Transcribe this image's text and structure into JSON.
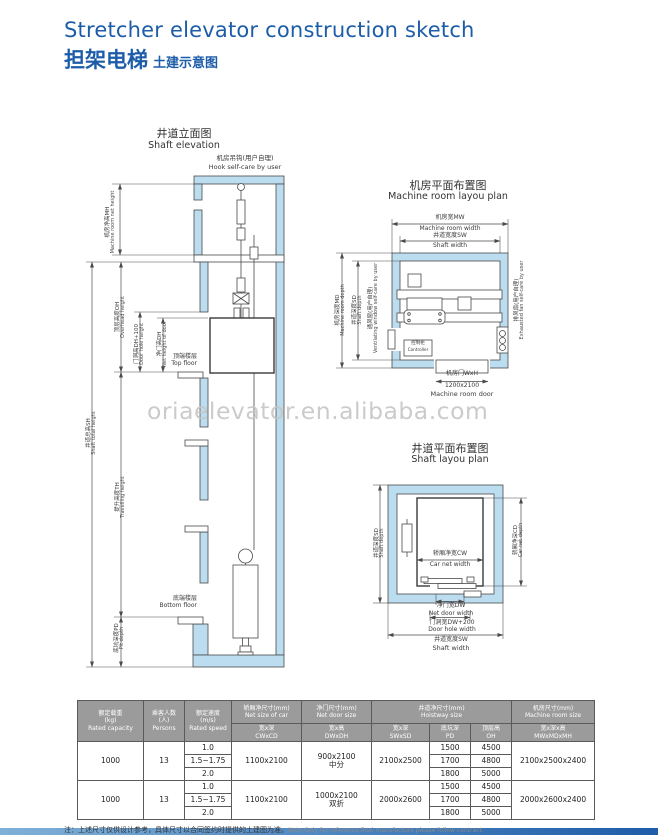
{
  "header": {
    "title_en": "Stretcher elevator construction sketch",
    "title_zh": "担架电梯",
    "title_zh_sub": "土建示意图"
  },
  "watermark": "oriaelevator.en.alibaba.com",
  "colors": {
    "accent_blue": "#1d5ca8",
    "wall_fill": "#bcdcf0",
    "line": "#4a4a4a",
    "table_header_bg": "#9b9b9b",
    "watermark_gray": "#c6c6c6"
  },
  "elevation": {
    "title_zh": "井道立面图",
    "title_en": "Shaft elevation",
    "hook_zh": "机房吊钩(用户自理)",
    "hook_en": "Hook self-care by user",
    "dims": {
      "mh_zh": "机房净高MH",
      "mh_en": "Machine room net height",
      "sh_zh": "井道总高SH",
      "sh_en": "Shaft total height",
      "oh_zh": "顶层高度OH",
      "oh_en": "Overhead height",
      "dh100_zh": "门洞高DH+100",
      "dh100_en": "Door hole height",
      "dh_zh": "净门高DH",
      "dh_en": "Net height of door",
      "th_zh": "提升高度TH",
      "th_en": "Travelling height",
      "pd_zh": "底坑深度PD",
      "pd_en": "Pit depth"
    },
    "top_floor_zh": "顶端楼层",
    "top_floor_en": "Top floor",
    "bottom_floor_zh": "底端楼层",
    "bottom_floor_en": "Bottom floor"
  },
  "machine_room_plan": {
    "title_zh": "机房平面布置图",
    "title_en": "Machine room layou plan",
    "mw_zh": "机房宽MW",
    "mw_en": "Machine room width",
    "sw_zh": "井道宽度SW",
    "sw_en": "Shaft width",
    "md_zh": "机房深度MD",
    "md_en": "Machine room depth",
    "sd_zh": "井道深度SD",
    "sd_en": "Shaft depth",
    "vent_zh": "通风窗(用户自理)",
    "vent_en": "Ventilating window self-care by user",
    "fan_zh": "排风扇(用户自理)",
    "fan_en": "Exhausted fan self-care by user",
    "controller_zh": "控制柜",
    "controller_en": "Controller",
    "door_zh": "机房门WxH",
    "door_size": "1200x2100",
    "door_en": "Machine room door"
  },
  "shaft_plan": {
    "title_zh": "井道平面布置图",
    "title_en": "Shaft  layou plan",
    "sd_zh": "井道深度SD",
    "sd_en": "Shaft depth",
    "cd_zh": "轿厢净深CD",
    "cd_en": "Car net depth",
    "cw_zh": "轿厢净宽CW",
    "cw_en": "Car net width",
    "dw_zh": "净门宽DW",
    "dw_en": "Net door width",
    "dhw_zh": "门洞宽DW+200",
    "dhw_en": "Door hole width",
    "sw_zh": "井道宽度SW",
    "sw_en": "Shaft width"
  },
  "spec_table": {
    "group_headers": [
      {
        "zh": "额定载重",
        "unit": "(kg)",
        "en": "Rated capacity"
      },
      {
        "zh": "乘客人数",
        "unit": "(人)",
        "en": "Persons"
      },
      {
        "zh": "额定速度",
        "unit": "(m/s)",
        "en": "Rated speed"
      },
      {
        "zh": "轿厢净尺寸(mm)",
        "en": "Net size of car"
      },
      {
        "zh": "净门尺寸(mm)",
        "en": "Net door size"
      },
      {
        "zh": "井道净尺寸(mm)",
        "en": "Hoistway size"
      },
      {
        "zh": "机房尺寸(mm)",
        "en": "Machine room size"
      }
    ],
    "sub_headers": [
      {
        "zh": "宽x深",
        "en": "CWxCD"
      },
      {
        "zh": "宽x高",
        "en": "DWxDH"
      },
      {
        "zh": "宽x深",
        "en": "SWxSD"
      },
      {
        "zh": "底坑深",
        "en": "PD"
      },
      {
        "zh": "顶层高",
        "en": "OH"
      },
      {
        "zh": "宽x深x高",
        "en": "MWxMDxMH"
      }
    ],
    "rows": [
      {
        "capacity": "1000",
        "persons": "13",
        "speeds": [
          "1.0",
          "1.5~1.75",
          "2.0"
        ],
        "car_size": "1100x2100",
        "door_size": "900x2100",
        "door_type": "中分",
        "hoistway": "2100x2500",
        "pit_depth": [
          "1500",
          "1700",
          "1800"
        ],
        "overhead": [
          "4500",
          "4800",
          "5000"
        ],
        "machine_room": "2100x2500x2400"
      },
      {
        "capacity": "1000",
        "persons": "13",
        "speeds": [
          "1.0",
          "1.5~1.75",
          "2.0"
        ],
        "car_size": "1100x2100",
        "door_size": "1000x2100",
        "door_type": "双折",
        "hoistway": "2000x2600",
        "pit_depth": [
          "1500",
          "1700",
          "1800"
        ],
        "overhead": [
          "4500",
          "4800",
          "5000"
        ],
        "machine_room": "2000x2600x2400"
      }
    ]
  },
  "note": {
    "zh": "注：上述尺寸仅供设计参考，具体尺寸以合同签约时提供的土建图为准。",
    "en": "Note:Only for reference,final manufacture please follow contract."
  }
}
